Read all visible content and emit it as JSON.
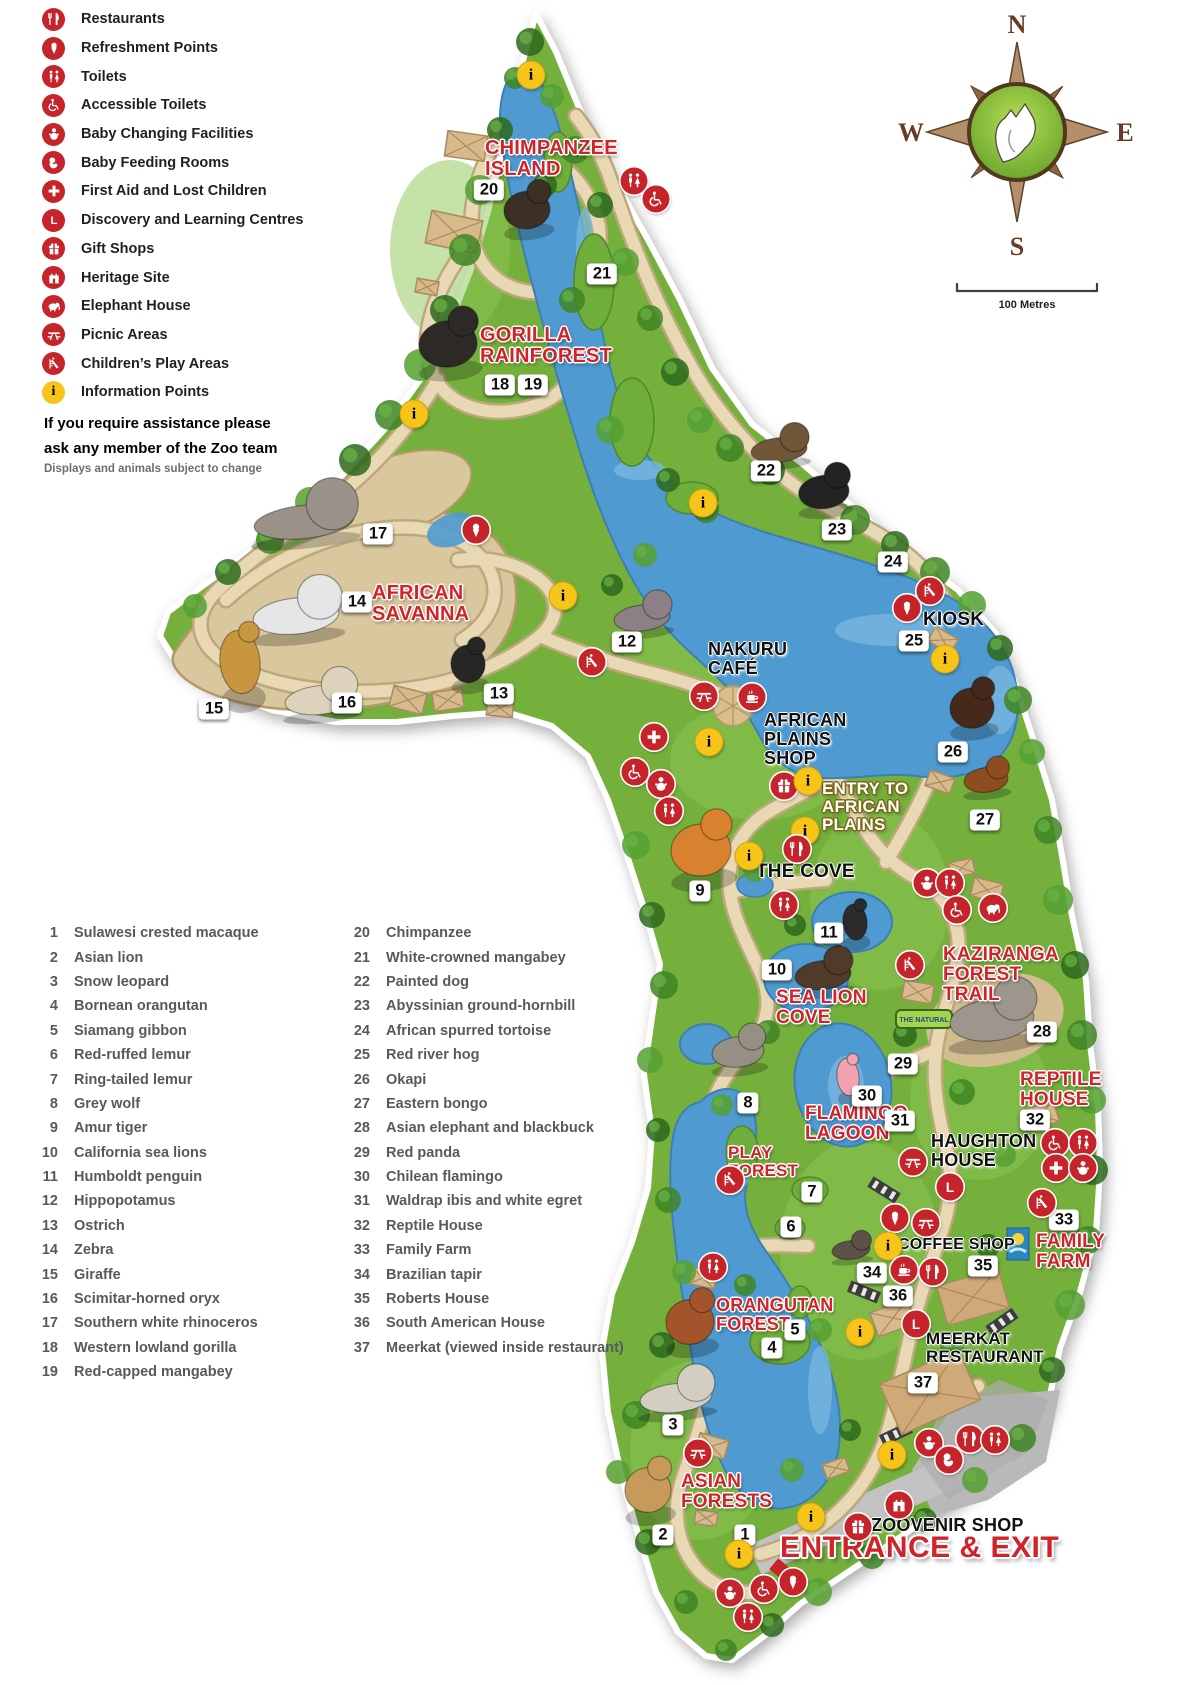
{
  "colors": {
    "icon_red": "#c5242b",
    "info_yellow": "#f7c51a",
    "label_red": "#d1232a",
    "land_green": "#74b03c",
    "lake_blue": "#4f9ad0",
    "sand": "#d9c79d"
  },
  "legend": {
    "items": [
      {
        "icon": "restaurants",
        "label": "Restaurants"
      },
      {
        "icon": "refreshment",
        "label": "Refreshment Points"
      },
      {
        "icon": "toilets",
        "label": "Toilets"
      },
      {
        "icon": "accessible",
        "label": "Accessible Toilets"
      },
      {
        "icon": "baby-changing",
        "label": "Baby Changing Facilities"
      },
      {
        "icon": "baby-feeding",
        "label": "Baby Feeding Rooms"
      },
      {
        "icon": "first-aid",
        "label": "First Aid and Lost Children"
      },
      {
        "icon": "learning",
        "label": "Discovery and Learning Centres"
      },
      {
        "icon": "gift",
        "label": "Gift Shops"
      },
      {
        "icon": "heritage",
        "label": "Heritage Site"
      },
      {
        "icon": "elephant-house",
        "label": "Elephant House"
      },
      {
        "icon": "picnic",
        "label": "Picnic Areas"
      },
      {
        "icon": "play",
        "label": "Children’s Play Areas"
      },
      {
        "icon": "info",
        "label": "Information Points"
      }
    ]
  },
  "assistance": {
    "text": "If you require assistance please\nask any member of the Zoo team",
    "note": "Displays and animals subject to change"
  },
  "animal_list": {
    "column1": [
      {
        "num": "1",
        "name": "Sulawesi crested macaque"
      },
      {
        "num": "2",
        "name": "Asian lion"
      },
      {
        "num": "3",
        "name": "Snow leopard"
      },
      {
        "num": "4",
        "name": "Bornean orangutan"
      },
      {
        "num": "5",
        "name": "Siamang gibbon"
      },
      {
        "num": "6",
        "name": "Red-ruffed lemur"
      },
      {
        "num": "7",
        "name": "Ring-tailed lemur"
      },
      {
        "num": "8",
        "name": "Grey wolf"
      },
      {
        "num": "9",
        "name": "Amur tiger"
      },
      {
        "num": "10",
        "name": "California sea lions"
      },
      {
        "num": "11",
        "name": "Humboldt penguin"
      },
      {
        "num": "12",
        "name": "Hippopotamus"
      },
      {
        "num": "13",
        "name": "Ostrich"
      },
      {
        "num": "14",
        "name": "Zebra"
      },
      {
        "num": "15",
        "name": "Giraffe"
      },
      {
        "num": "16",
        "name": "Scimitar-horned oryx"
      },
      {
        "num": "17",
        "name": "Southern white rhinoceros"
      },
      {
        "num": "18",
        "name": "Western lowland gorilla"
      },
      {
        "num": "19",
        "name": "Red-capped mangabey"
      }
    ],
    "column2": [
      {
        "num": "20",
        "name": "Chimpanzee"
      },
      {
        "num": "21",
        "name": "White-crowned mangabey"
      },
      {
        "num": "22",
        "name": "Painted dog"
      },
      {
        "num": "23",
        "name": "Abyssinian ground-hornbill"
      },
      {
        "num": "24",
        "name": "African spurred tortoise"
      },
      {
        "num": "25",
        "name": "Red river hog"
      },
      {
        "num": "26",
        "name": "Okapi"
      },
      {
        "num": "27",
        "name": "Eastern bongo"
      },
      {
        "num": "28",
        "name": "Asian elephant and blackbuck"
      },
      {
        "num": "29",
        "name": "Red panda"
      },
      {
        "num": "30",
        "name": "Chilean flamingo"
      },
      {
        "num": "31",
        "name": "Waldrap ibis and white egret"
      },
      {
        "num": "32",
        "name": "Reptile House"
      },
      {
        "num": "33",
        "name": "Family Farm"
      },
      {
        "num": "34",
        "name": "Brazilian tapir"
      },
      {
        "num": "35",
        "name": "Roberts House"
      },
      {
        "num": "36",
        "name": "South American House"
      },
      {
        "num": "37",
        "name": "Meerkat (viewed inside restaurant)"
      }
    ]
  },
  "compass": {
    "n": "N",
    "w": "W",
    "e": "E",
    "s": "S"
  },
  "scale": {
    "label": "100 Metres"
  },
  "map": {
    "labels": [
      {
        "id": "chimpanzee-island",
        "text": "CHIMPANZEE\nISLAND",
        "style": "red",
        "x": 485,
        "y": 138,
        "size": 20
      },
      {
        "id": "gorilla-rainforest",
        "text": "GORILLA\nRAINFOREST",
        "style": "red",
        "x": 480,
        "y": 325,
        "size": 20
      },
      {
        "id": "african-savanna",
        "text": "AFRICAN\nSAVANNA",
        "style": "red",
        "x": 372,
        "y": 583,
        "size": 20
      },
      {
        "id": "nakuru-cafe",
        "text": "NAKURU\nCAFÉ",
        "style": "black",
        "x": 708,
        "y": 640,
        "size": 18
      },
      {
        "id": "african-plains-shop",
        "text": "AFRICAN\nPLAINS\nSHOP",
        "style": "black",
        "x": 764,
        "y": 711,
        "size": 18
      },
      {
        "id": "entry-african-plains",
        "text": "ENTRY TO\nAFRICAN\nPLAINS",
        "style": "entry",
        "x": 822,
        "y": 780,
        "size": 17
      },
      {
        "id": "the-cove",
        "text": "THE COVE",
        "style": "black",
        "x": 756,
        "y": 862,
        "size": 19
      },
      {
        "id": "sea-lion-cove",
        "text": "SEA LION\nCOVE",
        "style": "red",
        "x": 776,
        "y": 988,
        "size": 19
      },
      {
        "id": "kaziranga-forest-trail",
        "text": "KAZIRANGA\nFOREST\nTRAIL",
        "style": "red",
        "x": 943,
        "y": 945,
        "size": 19
      },
      {
        "id": "reptile-house",
        "text": "REPTILE\nHOUSE",
        "style": "red",
        "x": 1020,
        "y": 1070,
        "size": 19
      },
      {
        "id": "flamingo-lagoon",
        "text": "FLAMINGO\nLAGOON",
        "style": "red",
        "x": 805,
        "y": 1104,
        "size": 19
      },
      {
        "id": "play-forest",
        "text": "PLAY\nFOREST",
        "style": "red",
        "x": 728,
        "y": 1144,
        "size": 17
      },
      {
        "id": "haughton-house",
        "text": "HAUGHTON\nHOUSE",
        "style": "black",
        "x": 931,
        "y": 1132,
        "size": 18
      },
      {
        "id": "coffee-shop",
        "text": "COFFEE SHOP",
        "style": "black",
        "x": 898,
        "y": 1237,
        "size": 16
      },
      {
        "id": "family-farm",
        "text": "FAMILY\nFARM",
        "style": "red",
        "x": 1036,
        "y": 1232,
        "size": 19
      },
      {
        "id": "orangutan-forest",
        "text": "ORANGUTAN\nFOREST",
        "style": "red",
        "x": 716,
        "y": 1296,
        "size": 18
      },
      {
        "id": "meerkat-restaurant",
        "text": "MEERKAT\nRESTAURANT",
        "style": "black",
        "x": 926,
        "y": 1330,
        "size": 17
      },
      {
        "id": "asian-forests",
        "text": "ASIAN\nFORESTS",
        "style": "red",
        "x": 681,
        "y": 1472,
        "size": 19
      },
      {
        "id": "zoovenir-shop",
        "text": "ZOOVENIR  SHOP",
        "style": "black",
        "x": 871,
        "y": 1516,
        "size": 18
      },
      {
        "id": "entrance-exit",
        "text": "ENTRANCE & EXIT",
        "style": "entrance",
        "x": 780,
        "y": 1532,
        "size": 30
      },
      {
        "id": "kiosk",
        "text": "KIOSK",
        "style": "black",
        "x": 923,
        "y": 610,
        "size": 19
      }
    ],
    "markers": [
      {
        "num": "1",
        "x": 745,
        "y": 1535
      },
      {
        "num": "2",
        "x": 663,
        "y": 1535
      },
      {
        "num": "3",
        "x": 673,
        "y": 1425
      },
      {
        "num": "4",
        "x": 772,
        "y": 1348
      },
      {
        "num": "5",
        "x": 795,
        "y": 1330
      },
      {
        "num": "6",
        "x": 791,
        "y": 1227
      },
      {
        "num": "7",
        "x": 812,
        "y": 1192
      },
      {
        "num": "8",
        "x": 748,
        "y": 1103
      },
      {
        "num": "9",
        "x": 700,
        "y": 891
      },
      {
        "num": "10",
        "x": 777,
        "y": 970
      },
      {
        "num": "11",
        "x": 829,
        "y": 933
      },
      {
        "num": "12",
        "x": 627,
        "y": 642
      },
      {
        "num": "13",
        "x": 499,
        "y": 694
      },
      {
        "num": "14",
        "x": 357,
        "y": 602
      },
      {
        "num": "15",
        "x": 214,
        "y": 709
      },
      {
        "num": "16",
        "x": 347,
        "y": 703
      },
      {
        "num": "17",
        "x": 378,
        "y": 534
      },
      {
        "num": "18",
        "x": 500,
        "y": 385
      },
      {
        "num": "19",
        "x": 533,
        "y": 385
      },
      {
        "num": "20",
        "x": 489,
        "y": 190
      },
      {
        "num": "21",
        "x": 602,
        "y": 274
      },
      {
        "num": "22",
        "x": 766,
        "y": 471
      },
      {
        "num": "23",
        "x": 837,
        "y": 530
      },
      {
        "num": "24",
        "x": 893,
        "y": 562
      },
      {
        "num": "25",
        "x": 914,
        "y": 641
      },
      {
        "num": "26",
        "x": 953,
        "y": 752
      },
      {
        "num": "27",
        "x": 985,
        "y": 820
      },
      {
        "num": "28",
        "x": 1042,
        "y": 1032
      },
      {
        "num": "29",
        "x": 903,
        "y": 1064
      },
      {
        "num": "30",
        "x": 867,
        "y": 1096
      },
      {
        "num": "31",
        "x": 900,
        "y": 1121
      },
      {
        "num": "32",
        "x": 1035,
        "y": 1120
      },
      {
        "num": "33",
        "x": 1064,
        "y": 1220
      },
      {
        "num": "34",
        "x": 872,
        "y": 1273
      },
      {
        "num": "35",
        "x": 983,
        "y": 1266
      },
      {
        "num": "36",
        "x": 898,
        "y": 1296
      },
      {
        "num": "37",
        "x": 923,
        "y": 1383
      }
    ],
    "icons": [
      {
        "type": "info",
        "x": 531,
        "y": 75
      },
      {
        "type": "toilets",
        "x": 634,
        "y": 181
      },
      {
        "type": "accessible",
        "x": 656,
        "y": 199
      },
      {
        "type": "info",
        "x": 414,
        "y": 414
      },
      {
        "type": "refreshment",
        "x": 476,
        "y": 530
      },
      {
        "type": "info",
        "x": 563,
        "y": 596
      },
      {
        "type": "play",
        "x": 592,
        "y": 662
      },
      {
        "type": "info",
        "x": 703,
        "y": 503
      },
      {
        "type": "picnic",
        "x": 704,
        "y": 696
      },
      {
        "type": "coffee",
        "x": 752,
        "y": 697
      },
      {
        "type": "first-aid",
        "x": 654,
        "y": 737
      },
      {
        "type": "info",
        "x": 709,
        "y": 742
      },
      {
        "type": "accessible",
        "x": 635,
        "y": 772
      },
      {
        "type": "baby-changing",
        "x": 661,
        "y": 784
      },
      {
        "type": "toilets",
        "x": 669,
        "y": 811
      },
      {
        "type": "gift",
        "x": 784,
        "y": 786
      },
      {
        "type": "info",
        "x": 808,
        "y": 781
      },
      {
        "type": "info",
        "x": 805,
        "y": 831
      },
      {
        "type": "restaurants",
        "x": 797,
        "y": 849
      },
      {
        "type": "info",
        "x": 749,
        "y": 856
      },
      {
        "type": "toilets",
        "x": 784,
        "y": 905
      },
      {
        "type": "baby-changing",
        "x": 927,
        "y": 883
      },
      {
        "type": "toilets",
        "x": 950,
        "y": 883
      },
      {
        "type": "accessible",
        "x": 957,
        "y": 910
      },
      {
        "type": "elephant-house",
        "x": 993,
        "y": 908
      },
      {
        "type": "play",
        "x": 910,
        "y": 965
      },
      {
        "type": "play",
        "x": 930,
        "y": 591
      },
      {
        "type": "refreshment",
        "x": 907,
        "y": 608
      },
      {
        "type": "info",
        "x": 945,
        "y": 659
      },
      {
        "type": "accessible",
        "x": 1055,
        "y": 1143
      },
      {
        "type": "toilets",
        "x": 1083,
        "y": 1143
      },
      {
        "type": "first-aid",
        "x": 1056,
        "y": 1168
      },
      {
        "type": "baby-changing",
        "x": 1083,
        "y": 1168
      },
      {
        "type": "picnic",
        "x": 913,
        "y": 1162
      },
      {
        "type": "learning",
        "x": 950,
        "y": 1187
      },
      {
        "type": "play",
        "x": 1042,
        "y": 1203
      },
      {
        "type": "refreshment",
        "x": 895,
        "y": 1218
      },
      {
        "type": "picnic",
        "x": 926,
        "y": 1223
      },
      {
        "type": "info",
        "x": 888,
        "y": 1246
      },
      {
        "type": "coffee",
        "x": 904,
        "y": 1270
      },
      {
        "type": "restaurants",
        "x": 933,
        "y": 1272
      },
      {
        "type": "learning",
        "x": 916,
        "y": 1324
      },
      {
        "type": "info",
        "x": 860,
        "y": 1332
      },
      {
        "type": "play",
        "x": 730,
        "y": 1180
      },
      {
        "type": "toilets",
        "x": 713,
        "y": 1267
      },
      {
        "type": "picnic",
        "x": 698,
        "y": 1453
      },
      {
        "type": "info",
        "x": 892,
        "y": 1455
      },
      {
        "type": "baby-changing",
        "x": 929,
        "y": 1443
      },
      {
        "type": "baby-feeding",
        "x": 949,
        "y": 1460
      },
      {
        "type": "restaurants",
        "x": 970,
        "y": 1439
      },
      {
        "type": "toilets",
        "x": 995,
        "y": 1440
      },
      {
        "type": "heritage",
        "x": 899,
        "y": 1505
      },
      {
        "type": "gift",
        "x": 858,
        "y": 1527
      },
      {
        "type": "info",
        "x": 811,
        "y": 1517
      },
      {
        "type": "info",
        "x": 739,
        "y": 1554
      },
      {
        "type": "refreshment",
        "x": 793,
        "y": 1582
      },
      {
        "type": "accessible",
        "x": 764,
        "y": 1589
      },
      {
        "type": "baby-changing",
        "x": 730,
        "y": 1593
      },
      {
        "type": "toilets",
        "x": 748,
        "y": 1617
      }
    ],
    "animals": [
      {
        "name": "chimpanzee",
        "x": 527,
        "y": 210,
        "w": 46,
        "h": 52,
        "color": "#3b2f26"
      },
      {
        "name": "gorilla",
        "x": 448,
        "y": 344,
        "w": 58,
        "h": 64,
        "color": "#2c2926"
      },
      {
        "name": "rhinoceros",
        "x": 304,
        "y": 522,
        "w": 100,
        "h": 46,
        "color": "#9a9189"
      },
      {
        "name": "zebra",
        "x": 296,
        "y": 616,
        "w": 86,
        "h": 50,
        "color": "#e6e6e6"
      },
      {
        "name": "giraffe",
        "x": 240,
        "y": 662,
        "w": 40,
        "h": 88,
        "color": "#c8963f"
      },
      {
        "name": "oryx",
        "x": 320,
        "y": 700,
        "w": 70,
        "h": 40,
        "color": "#ddd3bd"
      },
      {
        "name": "ostrich",
        "x": 468,
        "y": 664,
        "w": 34,
        "h": 52,
        "color": "#262626"
      },
      {
        "name": "hippopotamus",
        "x": 642,
        "y": 618,
        "w": 56,
        "h": 36,
        "color": "#8d7f86"
      },
      {
        "name": "painted-dog",
        "x": 779,
        "y": 450,
        "w": 56,
        "h": 34,
        "color": "#6f5737"
      },
      {
        "name": "ground-hornbill",
        "x": 824,
        "y": 492,
        "w": 50,
        "h": 46,
        "color": "#232323"
      },
      {
        "name": "okapi",
        "x": 972,
        "y": 708,
        "w": 44,
        "h": 56,
        "color": "#47291c"
      },
      {
        "name": "bongo",
        "x": 986,
        "y": 780,
        "w": 44,
        "h": 34,
        "color": "#8e4d1f"
      },
      {
        "name": "tiger",
        "x": 701,
        "y": 850,
        "w": 60,
        "h": 72,
        "color": "#d8822f"
      },
      {
        "name": "penguin",
        "x": 855,
        "y": 922,
        "w": 24,
        "h": 50,
        "color": "#2b2b2b"
      },
      {
        "name": "sea-lion",
        "x": 823,
        "y": 975,
        "w": 56,
        "h": 40,
        "color": "#503a2a"
      },
      {
        "name": "wolf",
        "x": 738,
        "y": 1052,
        "w": 52,
        "h": 42,
        "color": "#969084"
      },
      {
        "name": "elephants",
        "x": 992,
        "y": 1020,
        "w": 84,
        "h": 58,
        "color": "#9d968c"
      },
      {
        "name": "flamingo",
        "x": 848,
        "y": 1077,
        "w": 22,
        "h": 52,
        "color": "#f2a2b0"
      },
      {
        "name": "tapir",
        "x": 851,
        "y": 1250,
        "w": 38,
        "h": 26,
        "color": "#5d5148"
      },
      {
        "name": "orangutan",
        "x": 690,
        "y": 1322,
        "w": 48,
        "h": 62,
        "color": "#a3542a"
      },
      {
        "name": "snow-leopard",
        "x": 676,
        "y": 1398,
        "w": 72,
        "h": 40,
        "color": "#d3cec2"
      },
      {
        "name": "lion",
        "x": 648,
        "y": 1490,
        "w": 46,
        "h": 62,
        "color": "#c79a5c"
      }
    ],
    "signs": [
      {
        "id": "natural-sign",
        "text": "THE NATURAL",
        "x": 924,
        "y": 1019
      }
    ]
  }
}
